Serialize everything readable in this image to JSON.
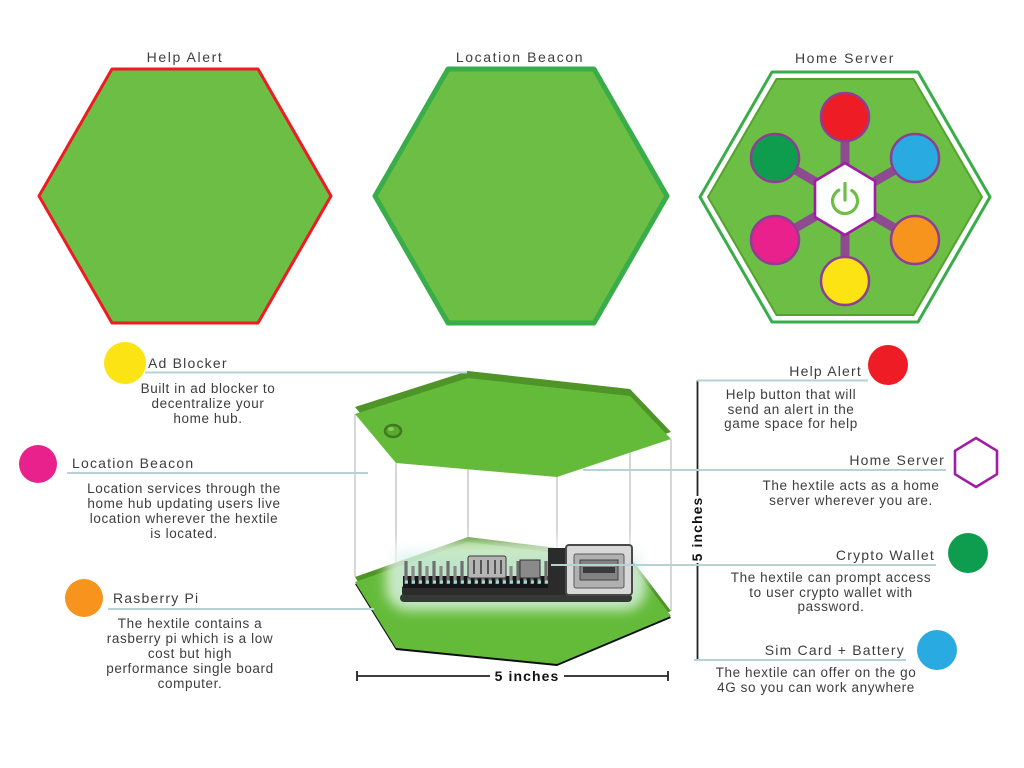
{
  "figures": [
    {
      "label": "Help Alert"
    },
    {
      "label": "Location Beacon"
    },
    {
      "label": "Home Server",
      "center_icon": "power-icon",
      "node_colors_clockwise_from_top": [
        "red",
        "blue",
        "orange",
        "yellow",
        "magenta",
        "green"
      ]
    }
  ],
  "dimensions": {
    "width_label": "5 inches",
    "height_label": "5 inches"
  },
  "annotations": {
    "left": [
      {
        "title": "Ad Blocker",
        "marker": "yellow-circle",
        "lines": [
          "Built in ad blocker to",
          "decentralize your",
          "home hub."
        ]
      },
      {
        "title": "Location Beacon",
        "marker": "magenta-circle",
        "lines": [
          "Location services through the",
          "home hub updating users live",
          "location wherever the hextile",
          "is located."
        ]
      },
      {
        "title": "Rasberry Pi",
        "marker": "orange-circle",
        "lines": [
          "The hextile contains a",
          "rasberry pi which is a low",
          "cost but high",
          "performance single board",
          "computer."
        ]
      }
    ],
    "right": [
      {
        "title": "Help Alert",
        "marker": "red-circle",
        "lines": [
          "Help button that will",
          "send an alert in the",
          "game space for help"
        ]
      },
      {
        "title": "Home Server",
        "marker": "purple-hexagon",
        "lines": [
          "The hextile acts as a home",
          "server wherever you are."
        ]
      },
      {
        "title": "Crypto Wallet",
        "marker": "green-circle",
        "lines": [
          "The hextile can prompt access",
          "to user crypto wallet with",
          "password."
        ]
      },
      {
        "title": "Sim Card + Battery",
        "marker": "blue-circle",
        "lines": [
          "The hextile can offer on the go",
          "4G so you can work anywhere"
        ]
      }
    ]
  },
  "colors": {
    "tile_green": "#6cbe45",
    "tile_green_dark": "#4e9427",
    "model_green": "#64bb3a",
    "outline_red": "#ed1c24",
    "outline_green": "#39ad49",
    "spoke_purple": "#8d4b90",
    "node_ring": "#8e3e94",
    "node_red": "#ee1c25",
    "node_blue": "#29abe2",
    "node_orange": "#f7941d",
    "node_yellow": "#fce313",
    "node_magenta": "#e9218c",
    "node_green": "#0e9d4f",
    "hex_purple": "#a21ba6",
    "callout_line": "#b7d2d4",
    "drop_line": "#c6c6c6",
    "text_dark": "#3d3d3d"
  }
}
